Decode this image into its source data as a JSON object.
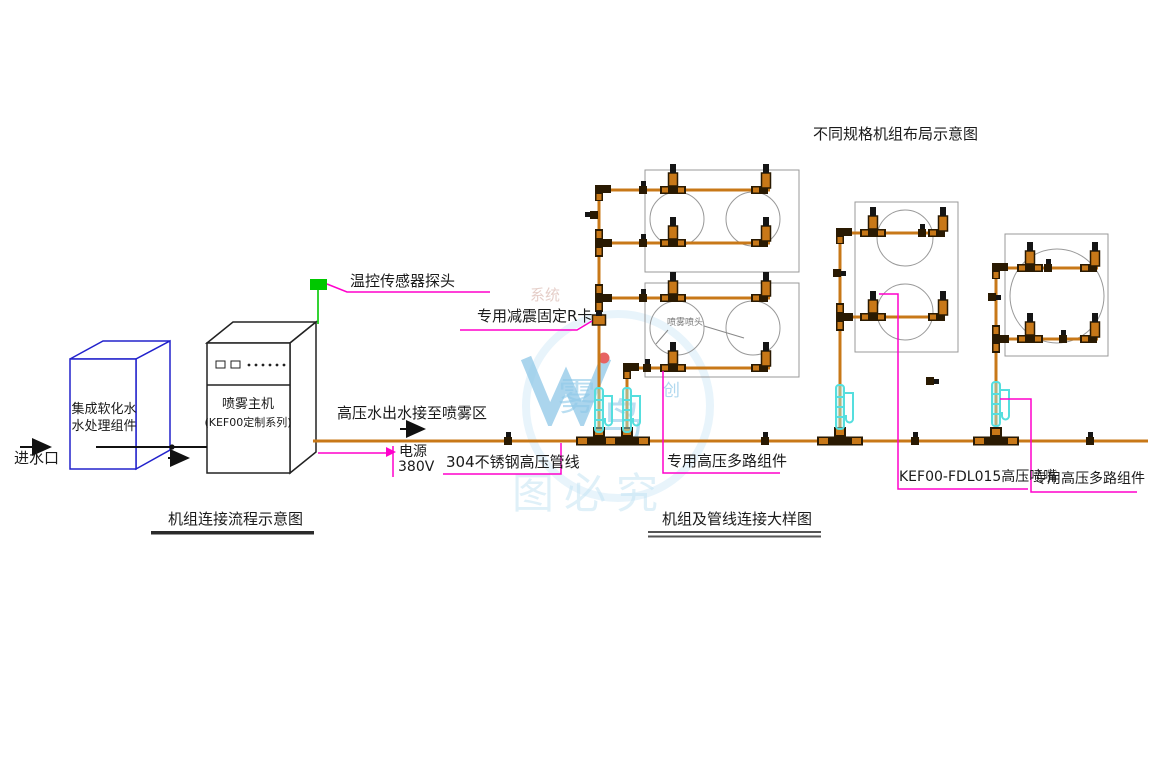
{
  "titles": {
    "layout_diagram": "不同规格机组布局示意图",
    "flow_diagram": "机组连接流程示意图",
    "detail_diagram": "机组及管线连接大样图"
  },
  "flow_section": {
    "water_inlet": "进水口",
    "softener_unit": {
      "line1": "集成软化水",
      "line2": "水处理组件"
    },
    "host_unit": {
      "line1": "喷雾主机",
      "line2": "(KEF00定制系列)"
    },
    "temp_sensor_label": "温控传感器探头",
    "outlet_label": "高压水出水接至喷雾区",
    "power_label": {
      "line1": "电源",
      "line2": "380V"
    }
  },
  "detail_section": {
    "r_clamp_label": "专用减震固定R卡",
    "pipe_label": "304不锈钢高压管线",
    "multiway_label_1": "专用高压多路组件",
    "spray_nozzle_small_label": "喷雾喷头",
    "nozzle_model_label": "KEF00-FDL015高压喷嘴",
    "multiway_label_2": "专用高压多路组件"
  },
  "watermark": {
    "logo_letter": "W",
    "char_1": "雾",
    "char_2": "鸟",
    "char_3": "创",
    "bottom_text": "图必究",
    "faint_text": "系统"
  },
  "colors": {
    "pipe_orange": "#C87818",
    "fitting_dark": "#2A1A02",
    "leader_magenta": "#FF00CC",
    "sensor_green": "#00C800",
    "nozzle_cyan": "#55DEDE",
    "box_blue": "#2222CC",
    "watermark_blue": "#A9D6EE"
  }
}
